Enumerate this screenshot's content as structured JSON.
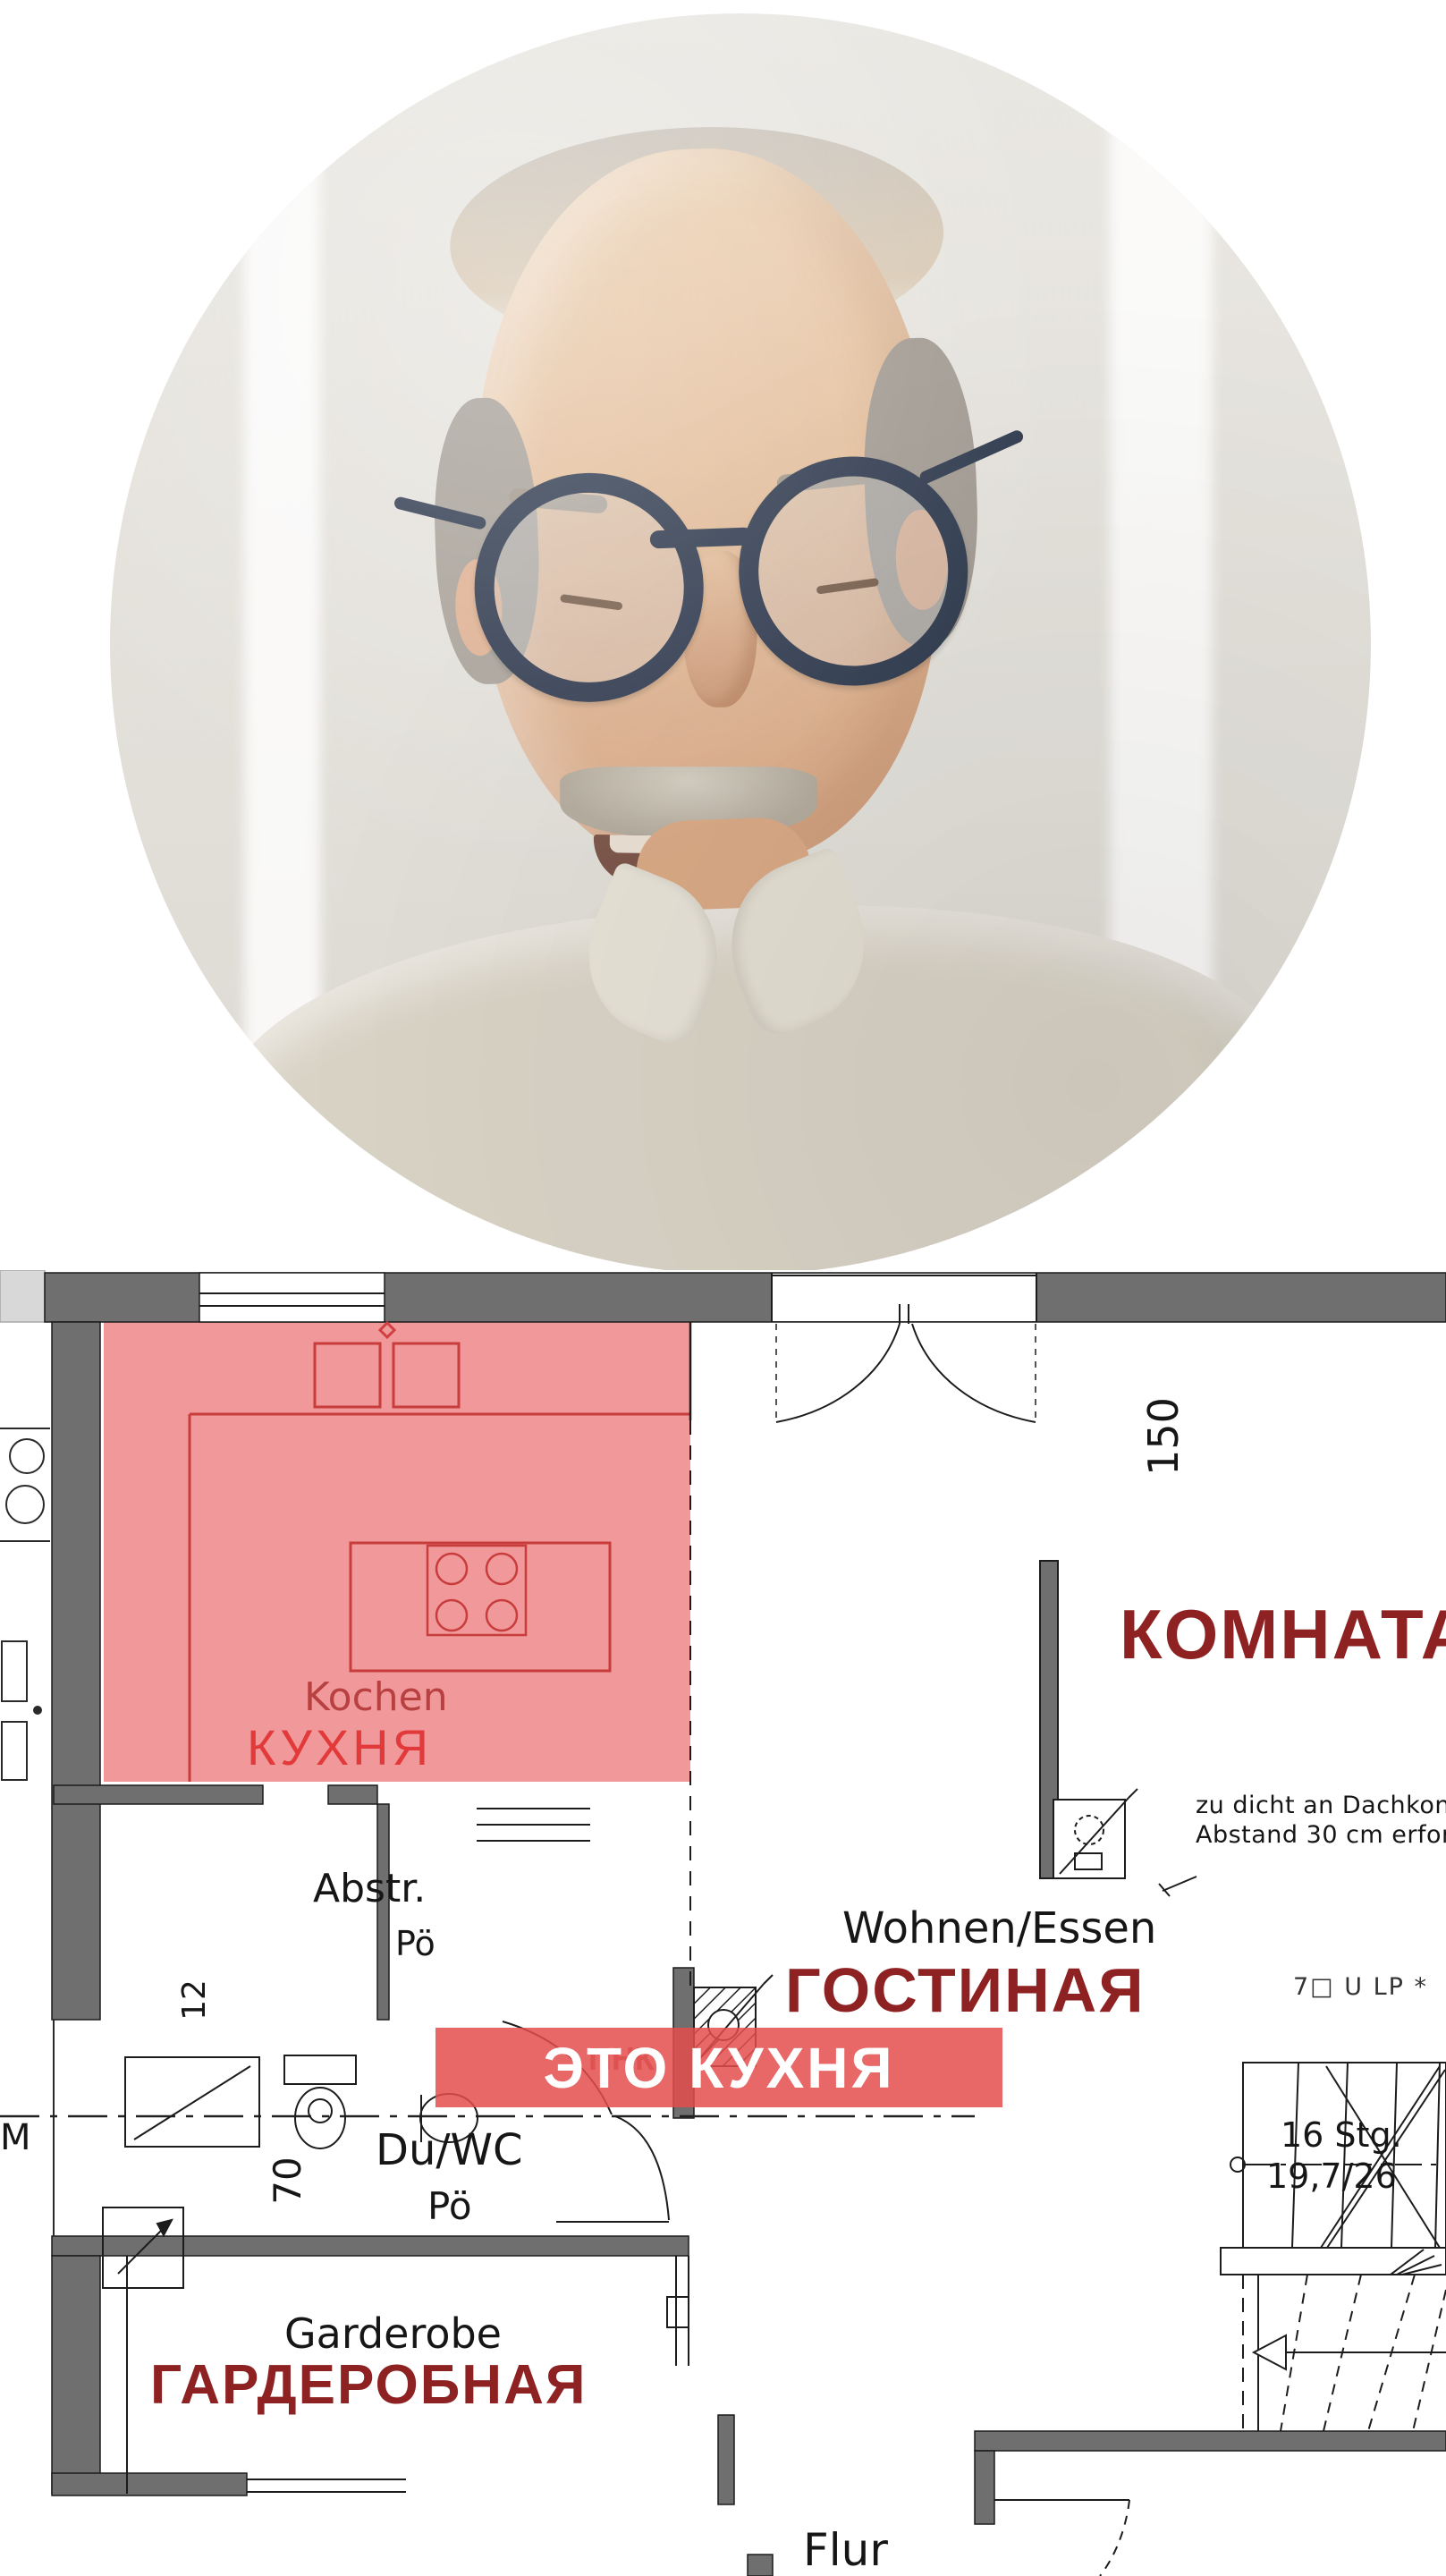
{
  "plan": {
    "rooms": {
      "kitchen": {
        "de": "Kochen",
        "ru": "КУХНЯ"
      },
      "living": {
        "de": "Wohnen/Essen",
        "ru": "ГОСТИНАЯ"
      },
      "room": {
        "ru": "КОМНАТА"
      },
      "storage": {
        "de": "Abstr.",
        "floor": "Pö"
      },
      "bath": {
        "de": "Du/WC",
        "floor": "Pö"
      },
      "wardrobe": {
        "de": "Garderobe",
        "ru": "ГАРДЕРОБНАЯ"
      },
      "hallway": {
        "de": "Flur"
      }
    },
    "overlay_banner": {
      "text": "ЭТО КУХНЯ"
    },
    "notes": {
      "roof_line1": "zu dicht an Dachkonst",
      "roof_line2": "Abstand 30 cm erford",
      "stairs_count": "16 Stg.",
      "stairs_ratio": "19,7/26",
      "ulp": "7□ U LP *",
      "pnk": "ПНК",
      "m": "M"
    },
    "dims": {
      "w150": "150",
      "w12": "12",
      "w70": "70"
    },
    "colors": {
      "highlight_pink": "#f0989a",
      "accent_red": "#c83c3c",
      "bright_red": "#e23a3a",
      "title_maroon": "#8e2222",
      "banner_red": "#e44e4e",
      "wall_gray": "#6f6f6f"
    }
  }
}
